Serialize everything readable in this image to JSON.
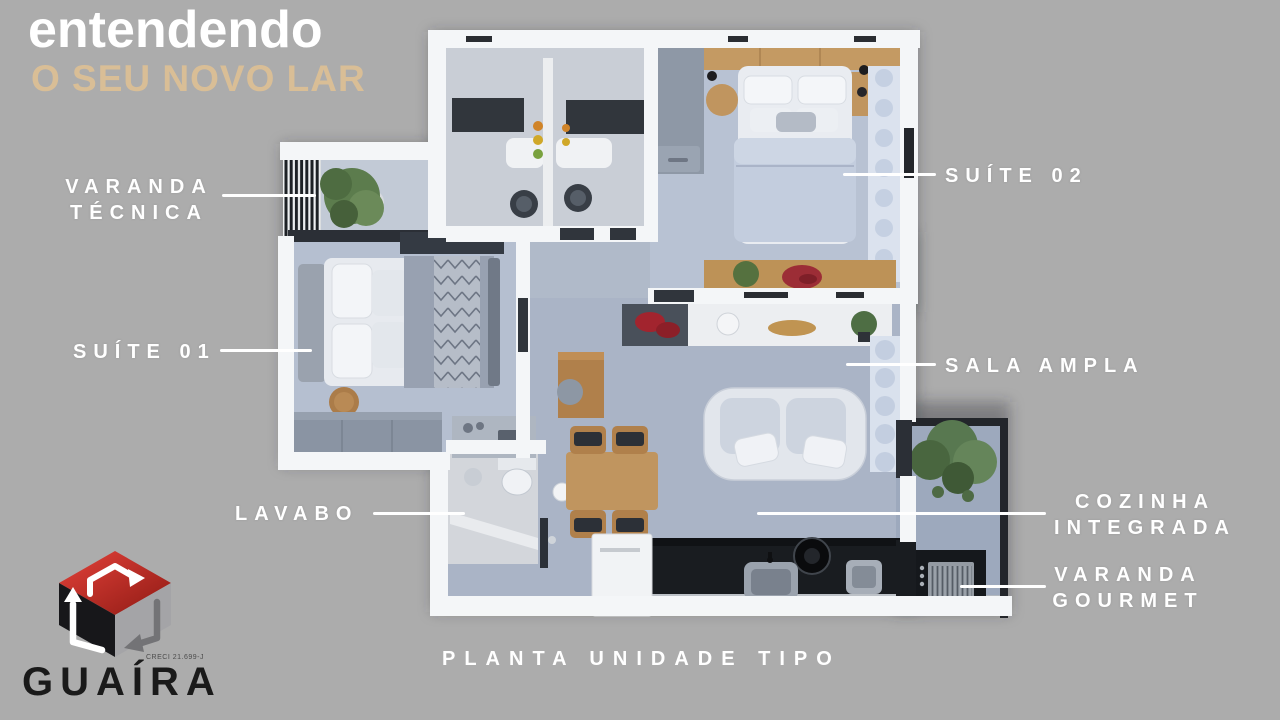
{
  "colors": {
    "background": "#ACACAC",
    "title": "#FFFFFF",
    "subtitle": "#D9BE96",
    "label_text": "#FFFFFF",
    "leader_line": "#FFFFFF",
    "logo_text": "#1A1A1A",
    "logo_red": "#C62B26",
    "logo_black": "#17171A",
    "logo_gray": "#A4A4A7"
  },
  "header": {
    "title": "entendendo",
    "subtitle": "O SEU NOVO LAR"
  },
  "labels": {
    "varanda_tecnica": {
      "line1": "VARANDA",
      "line2": "TÉCNICA"
    },
    "suite_02": {
      "text": "SUÍTE 02"
    },
    "suite_01": {
      "text": "SUÍTE 01"
    },
    "sala_ampla": {
      "text": "SALA AMPLA"
    },
    "lavabo": {
      "text": "LAVABO"
    },
    "cozinha_integrada": {
      "line1": "COZINHA",
      "line2": "INTEGRADA"
    },
    "varanda_gourmet": {
      "line1": "VARANDA",
      "line2": "GOURMET"
    }
  },
  "caption": "PLANTA UNIDADE TIPO",
  "logo": {
    "name": "GUAÍRA",
    "registration": "CRECI 21.699-J"
  }
}
